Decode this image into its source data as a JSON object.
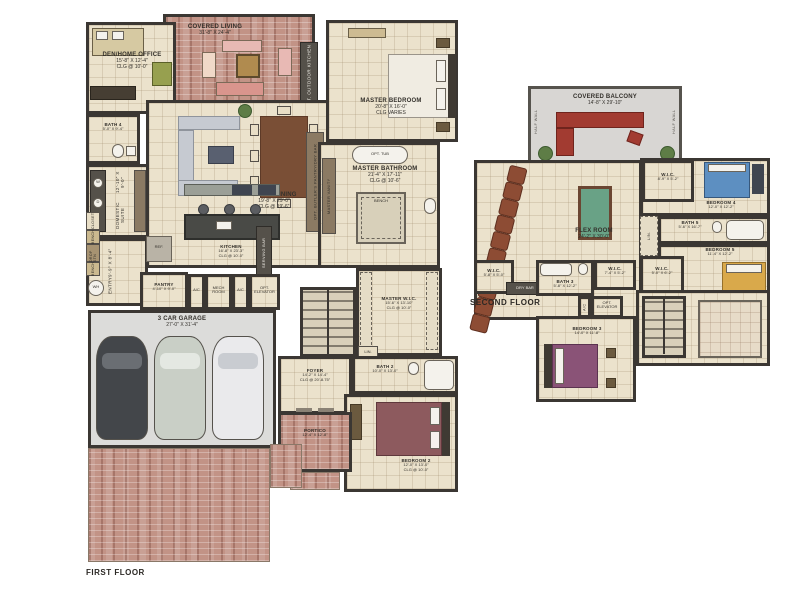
{
  "colors": {
    "wall": "#3b3733",
    "floor_tile": "#ebe2cc",
    "brick_paver": "#c29386",
    "garage_floor": "#dcdcda",
    "balcony_floor": "#d8d6d3",
    "pool_table_felt": "#69a286",
    "theater_chair": "#8d4c34",
    "balcony_sofa": "#a23b31",
    "bed2": "#8d5a5e",
    "bed3": "#8a5377",
    "bed4": "#5d8fc1",
    "bed5": "#d9a94b"
  },
  "first_floor": {
    "title": "FIRST FLOOR",
    "den": {
      "name": "DEN/HOME OFFICE",
      "dims": "15'-8\" X 12'-4\"",
      "clg": "CLG @ 10'-0\""
    },
    "covered_living": {
      "name": "COVERED LIVING",
      "dims": "31'-8\" X 24'-4\""
    },
    "opt_outdoor_kitchen": "OPT. OUTDOOR KITCHEN",
    "master_bedroom": {
      "name": "MASTER BEDROOM",
      "dims": "20'-8\" X 16'-0\"",
      "clg": "CLG VARIES"
    },
    "master_bathroom": {
      "name": "MASTER BATHROOM",
      "dims": "21'-4\" X 17'-11\"",
      "clg": "CLG @ 10'-6\""
    },
    "opt_tub": "OPT. TUB",
    "shower_bench": "BENCH",
    "master_vanity": "MASTER VANITY",
    "bath4": {
      "name": "BATH 4",
      "dims": "5'-0\" X 9'-4\""
    },
    "domestic_suite": {
      "name": "DOMESTIC SUITE",
      "dims": "12'-10\" X 9'-0\""
    },
    "washer": "W",
    "dryer": "D",
    "entry": {
      "name": "ENTRY",
      "dims": "9'-9\" X 8'-4\""
    },
    "living_dining": {
      "name": "LIVING/DINING",
      "dims": "19'-8\" X 29'-0\"",
      "clg": "CLG @ 19'-6\""
    },
    "kitchen": {
      "name": "KITCHEN",
      "dims": "16'-8\" X 23'-3\"",
      "clg": "CLG @ 10'-0\""
    },
    "butlers_pantry": "OPT. BUTLER'S PANTRY/DRY BAR",
    "serving_bar": "SERVING BAR",
    "ref": "REF.",
    "pantry": {
      "name": "PANTRY",
      "dims": "4'-10\" X 9'-0\""
    },
    "ac1": "A/C",
    "mech": "MECH ROOM",
    "ac2": "A/C",
    "opt_elevator": "OPT. ELEVATOR",
    "garage": {
      "name": "3 CAR GARAGE",
      "dims": "27'-0\" X 31'-4\""
    },
    "master_wic": {
      "name": "MASTER W.I.C.",
      "dims": "15'-6\" X 13'-10\"",
      "clg": "CLG @ 10'-0\""
    },
    "lin": "LIN.",
    "foyer": {
      "name": "FOYER",
      "dims": "14'-2\" X 14'-4\"",
      "clg": "CLG @ 20'-8.75\""
    },
    "bath2": {
      "name": "BATH 2",
      "dims": "10'-0\" X 13'-0\""
    },
    "bedroom2": {
      "name": "BEDROOM 2",
      "dims": "12'-0\" X 13'-0\"",
      "clg": "CLG @ 10'-0\""
    },
    "portico": {
      "name": "PORTICO",
      "dims": "12'-4\" X 12'-8\""
    },
    "closet": "CLOSET",
    "bench1": "BENCH",
    "drop_stn": "DROP STN",
    "bench2": "BENCH",
    "wh": "WH"
  },
  "second_floor": {
    "title": "SECOND FLOOR",
    "covered_balcony": {
      "name": "COVERED BALCONY",
      "dims": "14'-8\" X 29'-10\""
    },
    "half_wall": "HALF WALL",
    "flex_room": {
      "name": "FLEX ROOM",
      "dims": "24'-2\" X 30'-0\""
    },
    "wic_bed4": {
      "name": "W.I.C.",
      "dims": "8'-9\" X 5'-2\""
    },
    "bedroom4": {
      "name": "BEDROOM 4",
      "dims": "12'-0\" X 12'-2\""
    },
    "bath5": {
      "name": "BATH 5",
      "dims": "5'-6\" X 16'-7\""
    },
    "bedroom5": {
      "name": "BEDROOM 5",
      "dims": "11'-4\" X 12'-2\""
    },
    "wic_bed5": {
      "name": "W.I.C.",
      "dims": "5'-0\" X 6'-2\""
    },
    "wic_left": {
      "name": "W.I.C.",
      "dims": "5'-8\" X 5'-0\""
    },
    "bath3": {
      "name": "BATH 3",
      "dims": "5'-8\" X 12'-2\""
    },
    "wic_bed3": {
      "name": "W.I.C.",
      "dims": "7'-4\" X 5'-2\""
    },
    "dry_bar": "DRY BAR",
    "lin": "LIN.",
    "ac": "A/C",
    "opt_elevator": "OPT. ELEVATOR",
    "bedroom3": {
      "name": "BEDROOM 3",
      "dims": "14'-0\" X 11'-8\""
    }
  }
}
